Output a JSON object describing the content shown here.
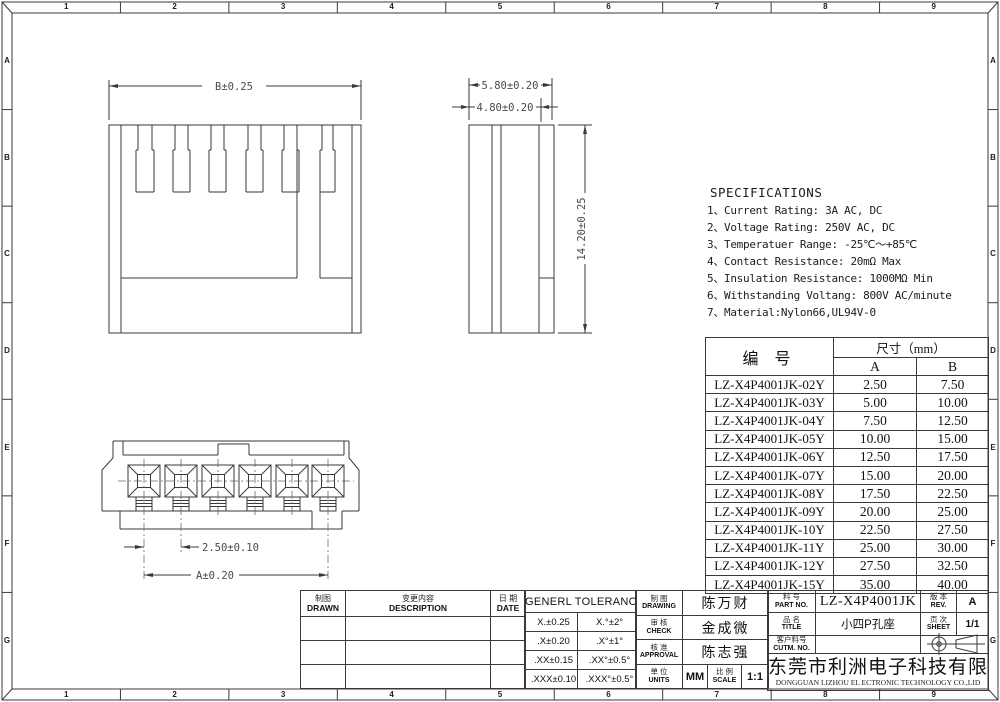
{
  "border": {
    "column_labels": [
      "1",
      "2",
      "3",
      "4",
      "5",
      "6",
      "7",
      "8",
      "9"
    ],
    "row_labels": [
      "A",
      "B",
      "C",
      "D",
      "E",
      "F",
      "G"
    ]
  },
  "views": {
    "front": {
      "width_dim": "B±0.25"
    },
    "side": {
      "width_dim": "5.80±0.20",
      "inner_width_dim": "4.80±0.20",
      "height_dim": "14.20±0.25"
    },
    "bottom": {
      "pitch_dim": "2.50±0.10",
      "span_dim": "A±0.20"
    }
  },
  "specs": {
    "title": "SPECIFICATIONS",
    "items": [
      "1、Current Rating: 3A AC, DC",
      "2、Voltage Rating: 250V AC, DC",
      "3、Temperatuer Range: -25℃～+85℃",
      "4、Contact Resistance: 20mΩ Max",
      "5、Insulation Resistance: 1000MΩ Min",
      "6、Withstanding Voltang: 800V AC/minute",
      "7、Material:Nylon66,UL94V-0"
    ]
  },
  "parts_table": {
    "part_header": "编  号",
    "size_header": "尺寸（mm）",
    "col_a": "A",
    "col_b": "B",
    "rows": [
      {
        "part": "LZ-X4P4001JK-02Y",
        "a": "2.50",
        "b": "7.50"
      },
      {
        "part": "LZ-X4P4001JK-03Y",
        "a": "5.00",
        "b": "10.00"
      },
      {
        "part": "LZ-X4P4001JK-04Y",
        "a": "7.50",
        "b": "12.50"
      },
      {
        "part": "LZ-X4P4001JK-05Y",
        "a": "10.00",
        "b": "15.00"
      },
      {
        "part": "LZ-X4P4001JK-06Y",
        "a": "12.50",
        "b": "17.50"
      },
      {
        "part": "LZ-X4P4001JK-07Y",
        "a": "15.00",
        "b": "20.00"
      },
      {
        "part": "LZ-X4P4001JK-08Y",
        "a": "17.50",
        "b": "22.50"
      },
      {
        "part": "LZ-X4P4001JK-09Y",
        "a": "20.00",
        "b": "25.00"
      },
      {
        "part": "LZ-X4P4001JK-10Y",
        "a": "22.50",
        "b": "27.50"
      },
      {
        "part": "LZ-X4P4001JK-11Y",
        "a": "25.00",
        "b": "30.00"
      },
      {
        "part": "LZ-X4P4001JK-12Y",
        "a": "27.50",
        "b": "32.50"
      },
      {
        "part": "LZ-X4P4001JK-15Y",
        "a": "35.00",
        "b": "40.00"
      }
    ]
  },
  "title_block": {
    "revision": {
      "drawn_cn": "制图",
      "drawn_en": "DRAWN",
      "description_cn": "变更内容",
      "description_en": "DESCRIPTION",
      "date_cn": "日 期",
      "date_en": "DATE"
    },
    "tolerance": {
      "header": "GENERL TOLERANCE",
      "rows": [
        [
          "X.±0.25",
          "X.°±2°"
        ],
        [
          ".X±0.20",
          ".X°±1°"
        ],
        [
          ".XX±0.15",
          ".XX°±0.5°"
        ],
        [
          ".XXX±0.10",
          ".XXX°±0.5°"
        ]
      ]
    },
    "signoff": {
      "drawing_cn": "制 图",
      "drawing_en": "DRAWING",
      "drawing_name": "陈万财",
      "check_cn": "审 核",
      "check_en": "CHECK",
      "check_name": "金成微",
      "approval_cn": "核 准",
      "approval_en": "APPROVAL",
      "approval_name": "陈志强",
      "units_cn": "单 位",
      "units_en": "UNITS",
      "units_value": "MM",
      "scale_cn": "比 例",
      "scale_en": "SCALE",
      "scale_value": "1:1"
    },
    "part": {
      "part_no_cn": "料 号",
      "part_no_en": "PART NO.",
      "part_no": "LZ-X4P4001JK",
      "rev_cn": "版 本",
      "rev_en": "REV.",
      "rev": "A",
      "title_cn": "品 名",
      "title_en": "TITLE",
      "title": "小四P孔座",
      "sheet_cn": "页 次",
      "sheet_en": "SHEET",
      "sheet": "1/1",
      "cutm_cn": "客户料号",
      "cutm_en": "CUTM. NO.",
      "cutm_value": ""
    },
    "company": {
      "cn": "东莞市利洲电子科技有限公司",
      "en": "DONGGUAN LIZHOU EL ECTRONIC TECHNOLOGY CO.,LID"
    }
  }
}
